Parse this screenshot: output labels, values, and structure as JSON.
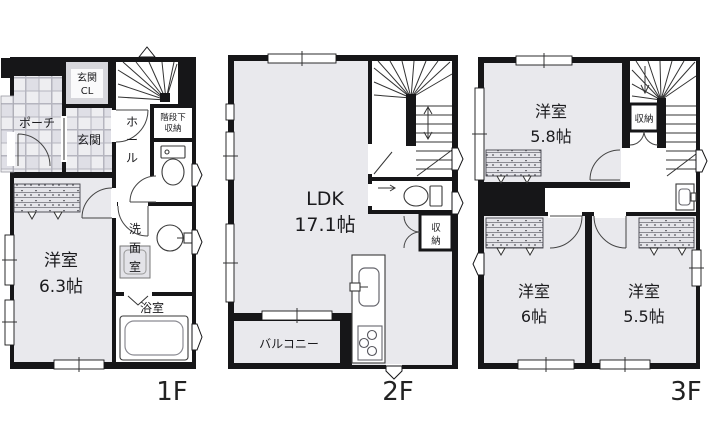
{
  "image_type": "real-estate floor plan, 3 storey house",
  "colors": {
    "wall": "#161618",
    "room_fill": "#e9e9ed",
    "tile_line": "#b5b5bf",
    "tile_dark": "#dfdfe6",
    "white": "#ffffff",
    "background": "#ffffff"
  },
  "floors": [
    {
      "label": "1F",
      "rooms": {
        "porch": "ポーチ",
        "genkan_cl_1": "玄関",
        "genkan_cl_2": "CL",
        "genkan": "玄関",
        "hall_1": "ホ",
        "hall_2": "ー",
        "hall_3": "ル",
        "stair_storage_1": "階段下",
        "stair_storage_2": "収納",
        "washroom_1": "洗",
        "washroom_2": "面",
        "washroom_3": "室",
        "bathroom": "浴室",
        "bedroom_1": "洋室",
        "bedroom_2": "6.3帖"
      }
    },
    {
      "label": "2F",
      "rooms": {
        "ldk_1": "LDK",
        "ldk_2": "17.1帖",
        "storage_1": "収",
        "storage_2": "納",
        "balcony": "バルコニー"
      }
    },
    {
      "label": "3F",
      "rooms": {
        "bedroom58_1": "洋室",
        "bedroom58_2": "5.8帖",
        "storage": "収納",
        "bedroom6_1": "洋室",
        "bedroom6_2": "6帖",
        "bedroom55_1": "洋室",
        "bedroom55_2": "5.5帖"
      }
    }
  ]
}
